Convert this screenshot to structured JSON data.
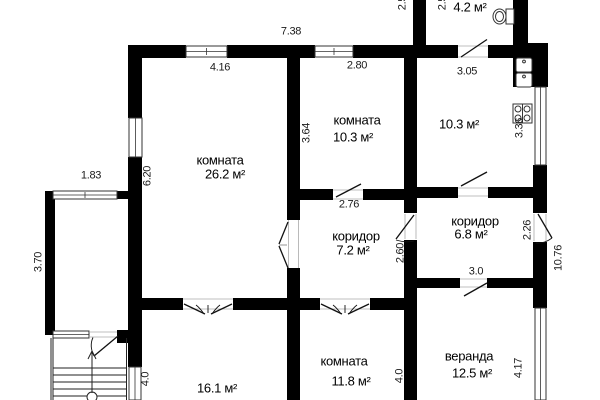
{
  "floorplan": {
    "colors": {
      "walls": "#000000",
      "background": "#ffffff",
      "thin_lines": "#333333"
    },
    "rooms": {
      "room_26_2": {
        "name": "комната",
        "area": "26.2 м²"
      },
      "room_10_3": {
        "name": "комната",
        "area": "10.3 м²"
      },
      "kitchen_10_3": {
        "area": "10.3 м²"
      },
      "corridor_7_2": {
        "name": "коридор",
        "area": "7.2 м²"
      },
      "corridor_6_8": {
        "name": "коридор",
        "area": "6.8 м²"
      },
      "room_11_8": {
        "name": "комната",
        "area": "11.8 м²"
      },
      "room_16_1": {
        "area": "16.1 м²"
      },
      "veranda_12_5": {
        "name": "веранда",
        "area": "12.5 м²"
      },
      "wc_4_2": {
        "area": "4.2 м²"
      }
    },
    "dimensions": {
      "d738": "7.38",
      "d416": "4.16",
      "d280": "2.80",
      "d305": "3.05",
      "d25a": "2.5",
      "d25b": "2.5",
      "d183": "1.83",
      "d620": "6.20",
      "d370": "3.70",
      "d364": "3.64",
      "d336": "3.36",
      "d276": "2.76",
      "d260": "2.60",
      "d226": "2.26",
      "d1076": "10.76",
      "d30": "3.0",
      "d40l": "4.0",
      "d40m": "4.0",
      "d417": "4.17"
    },
    "icons": {
      "toilet-icon": "toilet",
      "sink-icon": "double kitchen sink",
      "stove-icon": "4-burner stove",
      "stairs-icon": "staircase with up arrow"
    }
  }
}
